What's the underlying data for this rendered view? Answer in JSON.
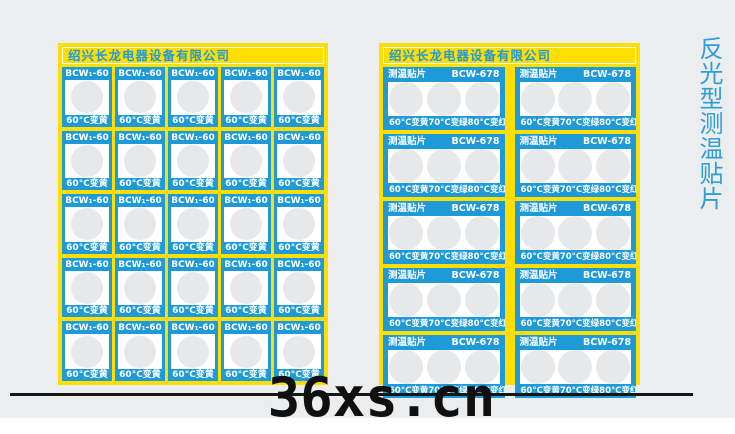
{
  "page": {
    "side_title": "反光型测温贴片",
    "watermark": "36xs.cn"
  },
  "left_panel": {
    "header": "绍兴长龙电器设备有限公司",
    "rows": 5,
    "cols": 5,
    "label": {
      "model": "BCW₁-60",
      "caption": "60°C变黄"
    }
  },
  "right_panel": {
    "header": "绍兴长龙电器设备有限公司",
    "rows": 5,
    "cols": 2,
    "label": {
      "title": "测温贴片",
      "model": "BCW-678",
      "captions": [
        "60°C变黄",
        "70°C变绿",
        "80°C变红"
      ]
    }
  },
  "colors": {
    "background": "#ECEDEE",
    "panel_yellow": "#FFDE00",
    "label_blue": "#1E9AD8",
    "indicator_circle": "#E7E8EA",
    "side_title_blue": "#2E9ED8",
    "watermark_black": "#101010"
  }
}
